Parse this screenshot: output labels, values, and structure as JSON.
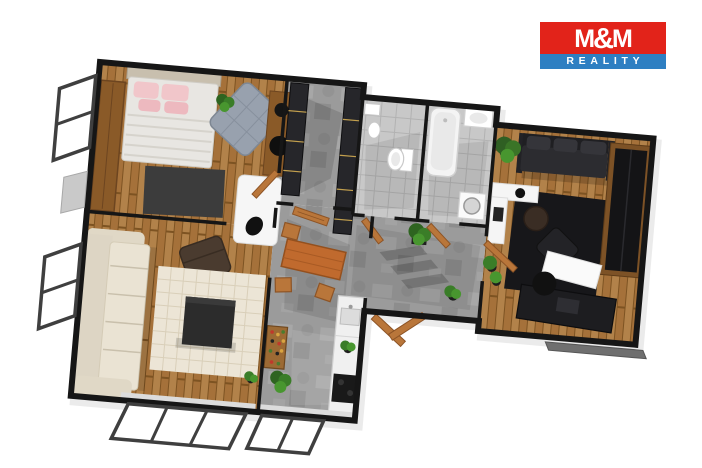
{
  "logo": {
    "title": "M&M",
    "subtitle": "REALITY",
    "title_bg": "#e2231a",
    "subtitle_bg": "#2e7fc2",
    "text_color": "#ffffff"
  },
  "palette": {
    "background": "#ffffff",
    "walls": "#161616",
    "wood_floor": "#ab7a3c",
    "concrete_floor": "#9b9b9b",
    "tile_floor": "#c8c8c8",
    "door_wood": "#b9763a",
    "sofa_cream": "#eae3d3",
    "sofa_dark": "#2c2c30",
    "pillow_pink": "#f1c6ca",
    "rug_living": "#ece5d6",
    "rug_bedroom": "#3c3c3c",
    "rug_office": "#17171a",
    "plant_green": "#3a7427",
    "counter_white": "#f0f0f0",
    "window_frame": "#3f3f3f"
  },
  "floorplan": {
    "view": "3d-top-down-apartment-render",
    "rooms": [
      "bedroom",
      "living-room",
      "hallway",
      "wc",
      "bathroom",
      "kitchen-dining",
      "corridor",
      "office-room"
    ]
  }
}
